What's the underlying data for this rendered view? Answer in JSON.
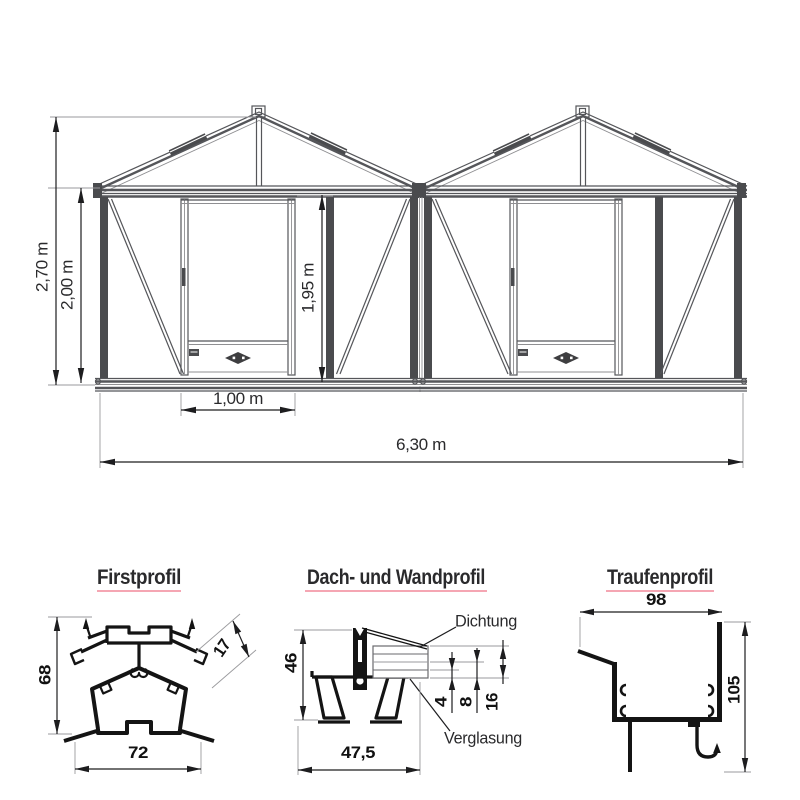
{
  "colors": {
    "accent_red": "#ee1c2e",
    "underline_pink": "#f2899a",
    "drawing_gray": "#55565a",
    "profile_black": "#141414"
  },
  "elevation": {
    "dims": {
      "height_total": "2,70 m",
      "height_eave": "2,00 m",
      "height_door": "1,95 m",
      "width_door": "1,00 m",
      "width_total": "6,30 m"
    }
  },
  "profiles": {
    "first": {
      "title": "Firstprofil",
      "dims": {
        "height": "68",
        "width": "72",
        "rebate": "17"
      }
    },
    "dach_wand": {
      "title": "Dach- und Wandprofil",
      "dims": {
        "height": "46",
        "width": "47,5",
        "pane": "4",
        "gap": "8",
        "total": "16"
      },
      "labels": {
        "seal": "Dichtung",
        "glazing": "Verglasung"
      }
    },
    "traufe": {
      "title": "Traufenprofil",
      "dims": {
        "width": "98",
        "height": "105"
      }
    }
  }
}
